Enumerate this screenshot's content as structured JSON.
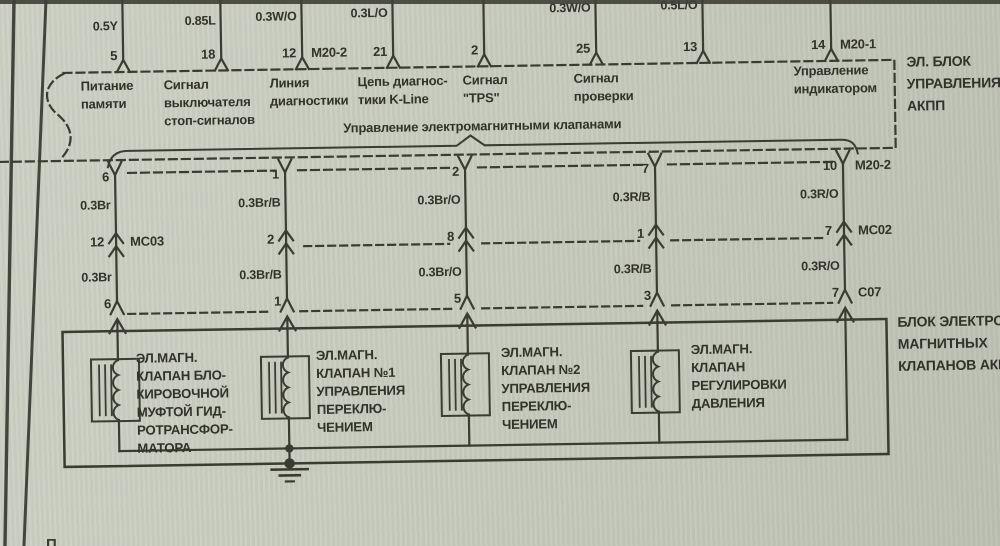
{
  "ecu": {
    "name_lines": [
      "ЭЛ. БЛОК",
      "УПРАВЛЕНИЯ",
      "АКПП"
    ],
    "pins": [
      {
        "num": "5",
        "wire": "0.5Y",
        "label_lines": [
          "Питание",
          "памяти"
        ]
      },
      {
        "num": "18",
        "wire": "0.85L",
        "label_lines": [
          "Сигнал",
          "выключателя",
          "стоп-сигналов"
        ]
      },
      {
        "num": "12",
        "connector": "M20-2",
        "wire": "0.3W/O",
        "label_lines": [
          "Линия",
          "диагностики"
        ]
      },
      {
        "num": "21",
        "wire": "0.3L/O",
        "label_lines": [
          "Цепь диагнос-",
          "тики K-Line"
        ]
      },
      {
        "num": "2",
        "label_lines": [
          "Сигнал",
          "\"TPS\""
        ]
      },
      {
        "num": "25",
        "wire": "0.3W/O",
        "label_lines": [
          "Сигнал",
          "проверки"
        ]
      },
      {
        "num": "13",
        "wire": "0.5L/O",
        "label_lines": []
      },
      {
        "num": "14",
        "connector": "M20-1",
        "label_lines": [
          "Управление",
          "индикатором"
        ]
      }
    ]
  },
  "valve_group_label": "Управление электромагнитными клапанами",
  "columns": [
    {
      "ecu_pin": "6",
      "wire_upper": "0.3Br",
      "mid_pin": "12",
      "mid_connector": "MC03",
      "wire_lower": "0.3Br",
      "block_pin": "6"
    },
    {
      "ecu_pin": "1",
      "wire_upper": "0.3Br/B",
      "mid_pin": "2",
      "wire_lower": "0.3Br/B",
      "block_pin": "1"
    },
    {
      "ecu_pin": "2",
      "wire_upper": "0.3Br/O",
      "mid_pin": "8",
      "wire_lower": "0.3Br/O",
      "block_pin": "5"
    },
    {
      "ecu_pin": "7",
      "wire_upper": "0.3R/B",
      "mid_pin": "1",
      "wire_lower": "0.3R/B",
      "block_pin": "3"
    },
    {
      "ecu_pin": "10",
      "ecu_connector": "M20-2",
      "wire_upper": "0.3R/O",
      "mid_pin": "7",
      "mid_connector": "MC02",
      "wire_lower": "0.3R/O",
      "block_pin": "7",
      "block_connector": "C07"
    }
  ],
  "valves": [
    {
      "label_lines": [
        "ЭЛ.МАГН.",
        "КЛАПАН БЛО-",
        "КИРОВОЧНОЙ",
        "МУФТОЙ ГИД-",
        "РОТРАНСФОР-",
        "МАТОРА"
      ]
    },
    {
      "label_lines": [
        "ЭЛ.МАГН.",
        "КЛАПАН №1",
        "УПРАВЛЕНИЯ",
        "ПЕРЕКЛЮ-",
        "ЧЕНИЕМ"
      ]
    },
    {
      "label_lines": [
        "ЭЛ.МАГН.",
        "КЛАПАН №2",
        "УПРАВЛЕНИЯ",
        "ПЕРЕКЛЮ-",
        "ЧЕНИЕМ"
      ]
    },
    {
      "label_lines": [
        "ЭЛ.МАГН.",
        "КЛАПАН",
        "РЕГУЛИРОВКИ",
        "ДАВЛЕНИЯ"
      ]
    }
  ],
  "solenoid_block": {
    "name_lines": [
      "БЛОК ЭЛЕКТРО",
      "МАГНИТНЫХ",
      "КЛАПАНОВ АКПП"
    ]
  },
  "page": {
    "bottom_fragment": "П"
  },
  "colors": {
    "paper": "#c8ccbe",
    "ink": "#3a3b31"
  }
}
